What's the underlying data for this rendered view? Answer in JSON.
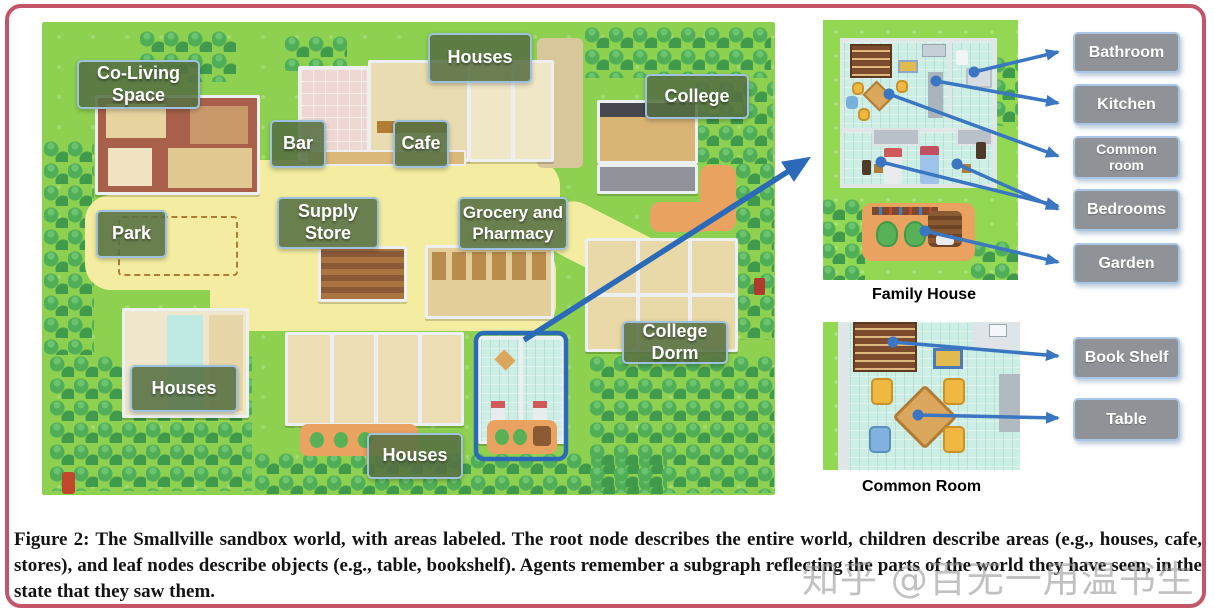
{
  "figure": {
    "caption": "Figure 2: The Smallville sandbox world, with areas labeled. The root node describes the entire world, children describe areas (e.g., houses, cafe, stores), and leaf nodes describe objects (e.g., table, bookshelf). Agents remember a subgraph reflecting the parts of the world they have seen, in the state that they saw them.",
    "watermark": "知乎 @百无一用温书生"
  },
  "map": {
    "areas": [
      {
        "label": "Co-Living Space"
      },
      {
        "label": "Houses"
      },
      {
        "label": "Bar"
      },
      {
        "label": "Cafe"
      },
      {
        "label": "College"
      },
      {
        "label": "Supply Store"
      },
      {
        "label": "Grocery and Pharmacy"
      },
      {
        "label": "Park"
      },
      {
        "label": "College Dorm"
      },
      {
        "label": "Houses"
      },
      {
        "label": "Houses"
      }
    ]
  },
  "family_house": {
    "caption": "Family House",
    "labels": [
      "Bathroom",
      "Kitchen",
      "Common room",
      "Bedrooms",
      "Garden"
    ]
  },
  "common_room": {
    "caption": "Common Room",
    "labels": [
      "Book Shelf",
      "Table"
    ]
  },
  "colors": {
    "frame_border": "#c45568",
    "arrow_blue": "#3a76c1",
    "highlight_box_blue": "#2b6ab8",
    "map_label_bg": "#56713f",
    "map_label_border": "#9ec2dd",
    "callout_bg": "#8f9398",
    "callout_border": "#a9c6e6",
    "grass_green": "#8ed150",
    "path_yellow": "#f4eda1",
    "garden_orange": "#e9a25f"
  }
}
